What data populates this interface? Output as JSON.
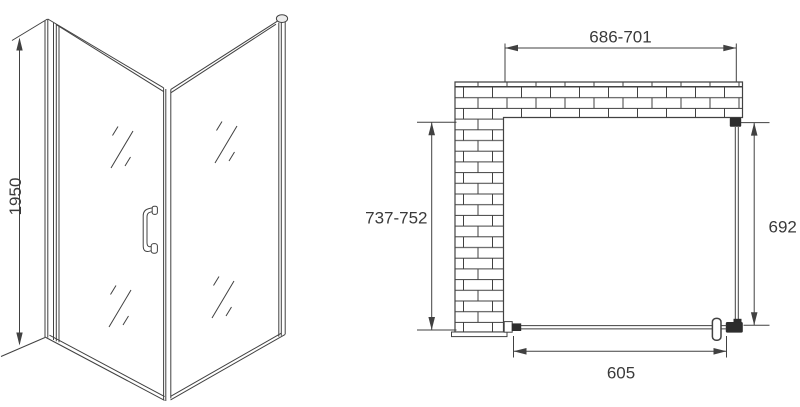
{
  "colors": {
    "line": "#414141",
    "text": "#3a3a3a",
    "dark_fill": "#2d2d2d",
    "background": "#ffffff",
    "cap_fill": "#ededed"
  },
  "perspective_view": {
    "height_label": "1950"
  },
  "plan_view": {
    "top_width_label": "686-701",
    "left_depth_label": "737-752",
    "right_depth_label": "692",
    "bottom_door_label": "605"
  }
}
